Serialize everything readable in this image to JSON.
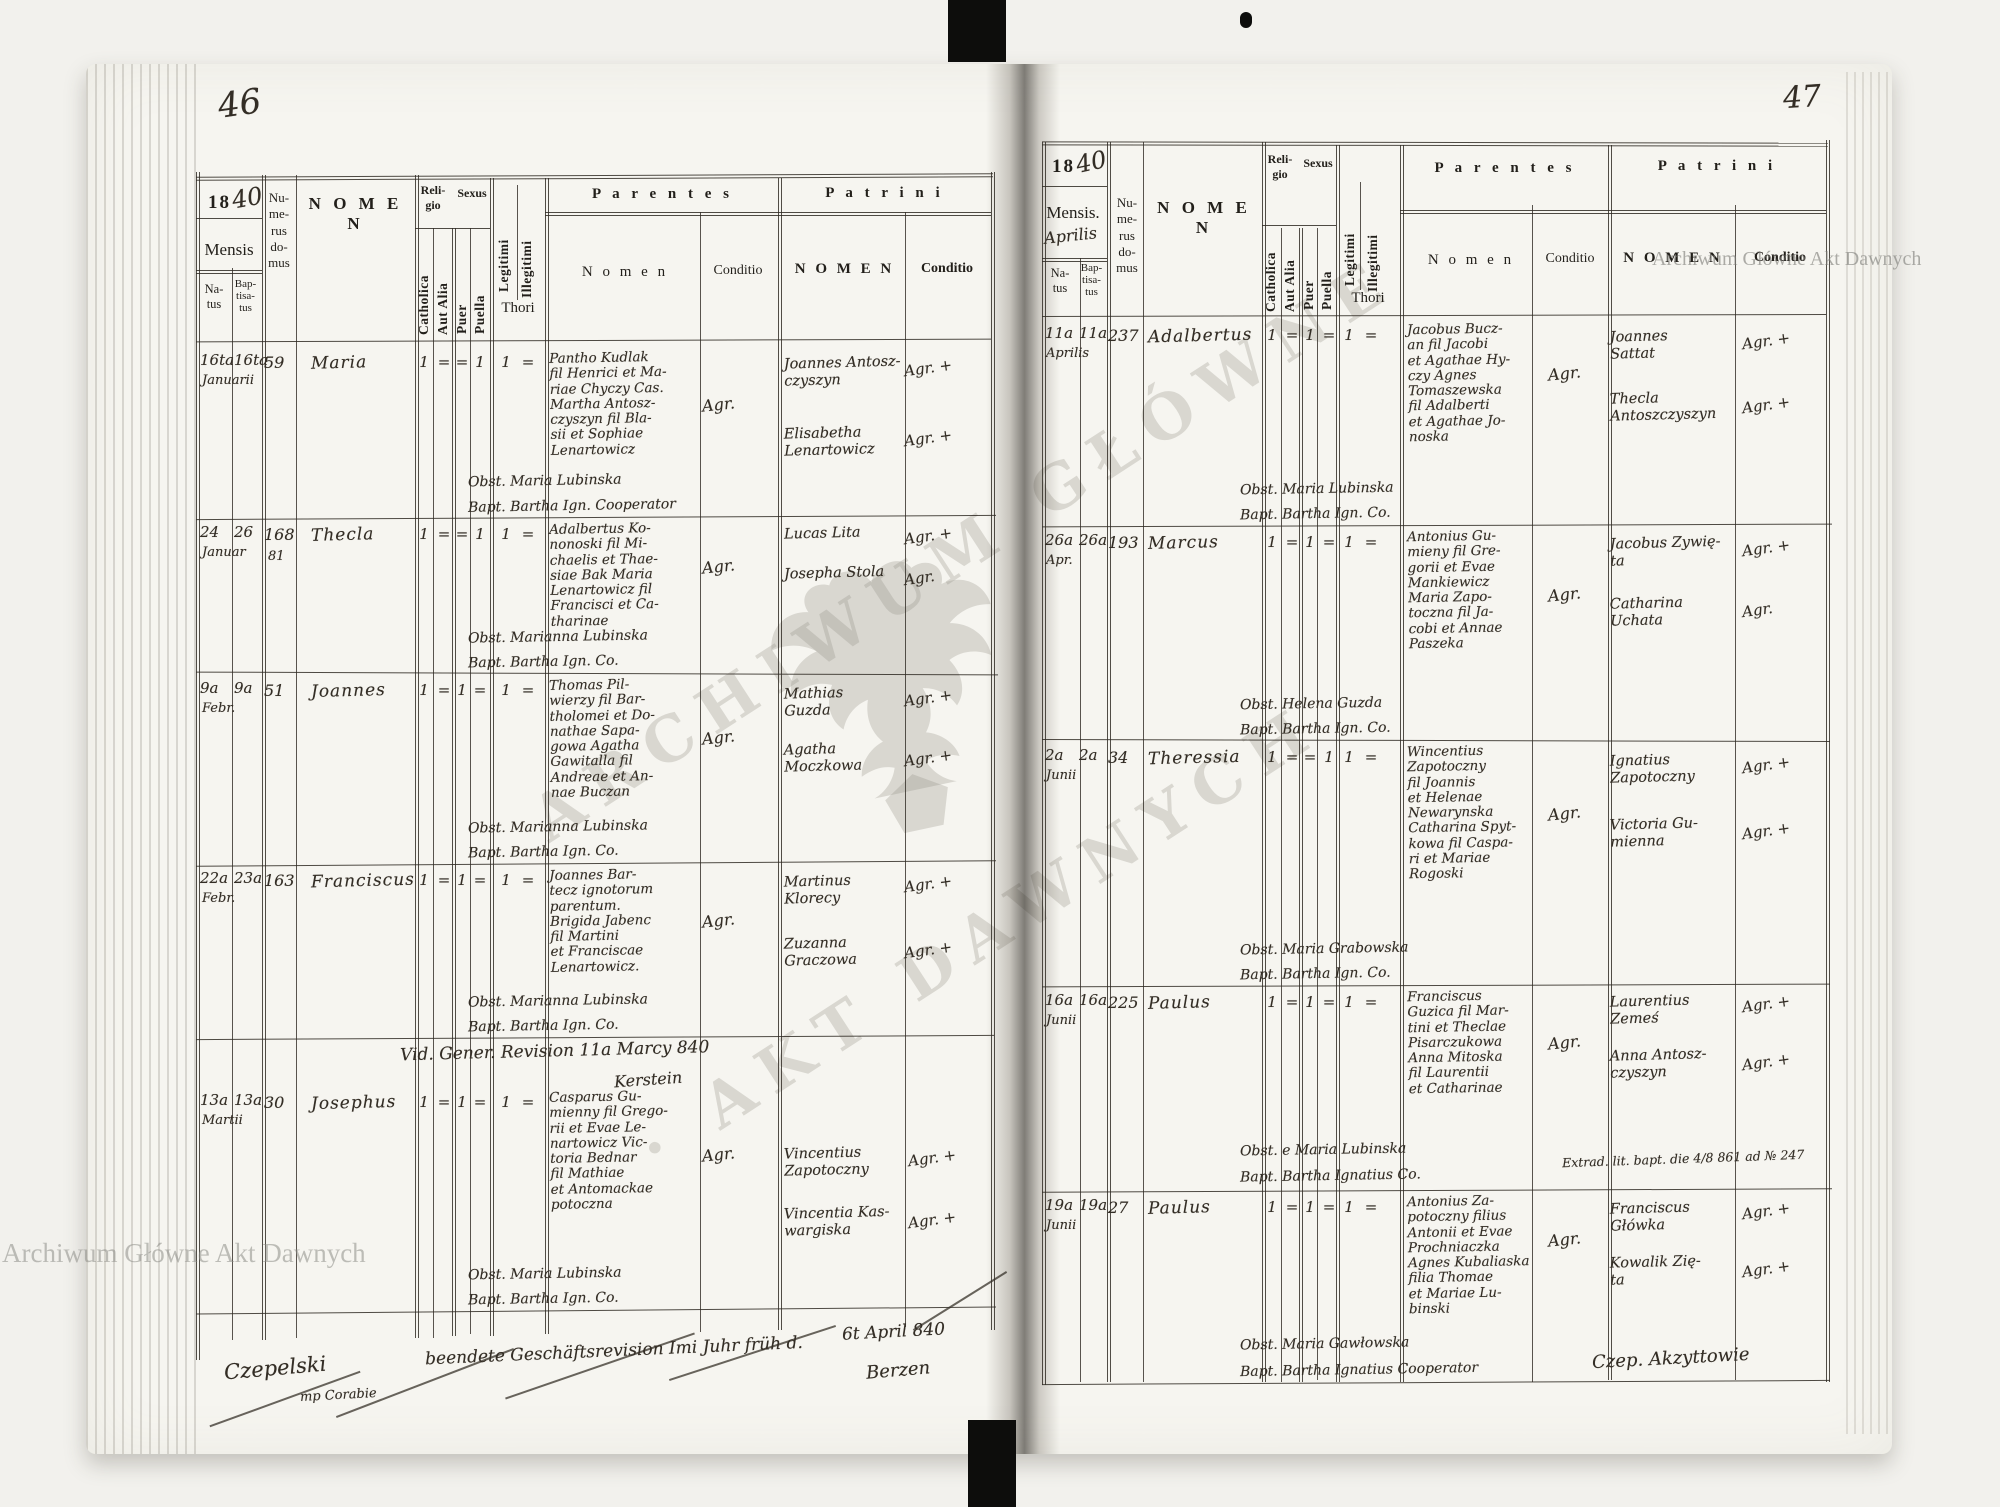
{
  "scan": {
    "page_left_number": "46",
    "page_right_number": "47",
    "watermark_top_right": "Archiwum Główne Akt Dawnych",
    "watermark_bottom_left": "Archiwum Główne Akt Dawnych",
    "watermark_center_line1": "ARCHIWUM GŁÓWNE",
    "watermark_center_line2": "· AKT DAWNYCH"
  },
  "labels": {
    "year_prefix": "18",
    "mensis": "Mensis",
    "mensis_dot": "Mensis.",
    "natus": "Na-\ntus",
    "baptisatus": "Bap-\ntisa-\ntus",
    "numerus": "Nu-\nme-\nrus\ndo-\nmus",
    "nomen_spaced": "N O M E N",
    "religio": "Reli-\ngio",
    "sexus": "Sexus",
    "catholica": "Catholica",
    "aut_alia": "Aut Alia",
    "puer": "Puer",
    "puella": "Puella",
    "legitimi": "Legitimi",
    "illegitimi": "Illegitimi",
    "thori": "Thori",
    "parentes": "P a r e n t e s",
    "patrini": "P a t r i n i",
    "parentes_nomen": "N o m e n",
    "conditio": "Conditio"
  },
  "left": {
    "year_hand": "40",
    "rows": [
      {
        "natus": "16ta",
        "bapt": "16ta",
        "month": "Januarii",
        "house": "59",
        "name": "Maria",
        "cath": "1",
        "alia": "=",
        "puer": "=",
        "puella": "1",
        "legit": "1",
        "illeg": "=",
        "parentes": "Pantho Kudlak\nfil Henrici et Ma-\nriae Chyczy Cas.\nMartha Antosz-\nczyszyn fil Bla-\nsii et Sophiae\nLenartowicz",
        "conditio": "Agr.",
        "obst": "Obst. Maria Lubinska",
        "baptizer": "Bapt. Bartha Ign. Cooperator",
        "patrini1": "Joannes Antosz-\nczyszyn",
        "cond1": "Agr. +",
        "patrini2": "Elisabetha\nLenartowicz",
        "cond2": "Agr. +"
      },
      {
        "natus": "24",
        "bapt": "26",
        "month": "Januar",
        "house": "168",
        "house2": "81",
        "name": "Thecla",
        "cath": "1",
        "alia": "=",
        "puer": "=",
        "puella": "1",
        "legit": "1",
        "illeg": "=",
        "parentes": "Adalbertus Ko-\nnonoski fil Mi-\nchaelis et Thae-\nsiae Bak Maria\nLenartowicz fil\nFrancisci et Ca-\ntharinae",
        "conditio": "Agr.",
        "obst": "Obst. Marianna Lubinska",
        "baptizer": "Bapt. Bartha Ign. Co.",
        "patrini1": "Lucas Lita",
        "cond1": "Agr. +",
        "patrini2": "Josepha Stola",
        "cond2": "Agr."
      },
      {
        "natus": "9a",
        "bapt": "9a",
        "month": "Febr.",
        "house": "51",
        "name": "Joannes",
        "cath": "1",
        "alia": "=",
        "puer": "1",
        "puella": "=",
        "legit": "1",
        "illeg": "=",
        "parentes": "Thomas Pil-\nwierzy fil Bar-\ntholomei et Do-\nnathae Sapa-\ngowa Agatha\nGawitalla fil\nAndreae et An-\nnae Buczan",
        "conditio": "Agr.",
        "obst": "Obst. Marianna Lubinska",
        "baptizer": "Bapt. Bartha Ign. Co.",
        "patrini1": "Mathias\nGuzda",
        "cond1": "Agr. +",
        "patrini2": "Agatha\nMoczkowa",
        "cond2": "Agr. +"
      },
      {
        "natus": "22a",
        "bapt": "23a",
        "month": "Febr.",
        "house": "163",
        "name": "Franciscus",
        "cath": "1",
        "alia": "=",
        "puer": "1",
        "puella": "=",
        "legit": "1",
        "illeg": "=",
        "parentes": "Joannes Bar-\ntecz ignotorum\nparentum.\nBrigida Jabenc\nfil Martini\net Franciscae\nLenartowicz.",
        "conditio": "Agr.",
        "obst": "Obst. Marianna Lubinska",
        "baptizer": "Bapt. Bartha Ign. Co.",
        "patrini1": "Martinus\nKlorecy",
        "cond1": "Agr. +",
        "patrini2": "Zuzanna\nGraczowa",
        "cond2": "Agr. +"
      },
      {
        "natus": "13a",
        "bapt": "13a",
        "month": "Martii",
        "house": "30",
        "name": "Josephus",
        "cath": "1",
        "alia": "=",
        "puer": "1",
        "puella": "=",
        "legit": "1",
        "illeg": "=",
        "parentes": "Casparus Gu-\nmienny fil Grego-\nrii et Evae Le-\nnartowicz Vic-\ntoria Bednar\nfil Mathiae\net Antomackae\npotoczna",
        "conditio": "Agr.",
        "obst": "Obst. Maria Lubinska",
        "baptizer": "Bapt. Bartha Ign. Co.",
        "patrini1": "Vincentius\nZapotoczny",
        "cond1": "Agr. +",
        "patrini2": "Vincentia Kas-\nwargiska",
        "cond2": "Agr. +"
      }
    ],
    "revision_note": "Vid. Gener. Revision 11a Marcy 840",
    "revision_sign": "Kerstein",
    "footer_line": "beendete Geschäftsrevision Imi Juhr früh d.",
    "footer_date": "6t April 840",
    "footer_place": "Berzen",
    "footer_sign": "Czepelski",
    "footer_sign_sub": "mp Corabie"
  },
  "right": {
    "year_hand": "40",
    "month_hand": "Aprilis",
    "rows": [
      {
        "natus": "11a",
        "bapt": "11a",
        "month": "Aprilis",
        "house": "237",
        "name": "Adalbertus",
        "cath": "1",
        "alia": "=",
        "puer": "1",
        "puella": "=",
        "legit": "1",
        "illeg": "=",
        "parentes": "Jacobus Bucz-\nan fil Jacobi\net Agathae Hy-\nczy Agnes\nTomaszewska\nfil Adalberti\net Agathae Jo-\nnoska",
        "conditio": "Agr.",
        "obst": "Obst. Maria Lubinska",
        "baptizer": "Bapt. Bartha Ign. Co.",
        "patrini1": "Joannes\nSattat",
        "cond1": "Agr. +",
        "patrini2": "Thecla\nAntoszczyszyn",
        "cond2": "Agr. +"
      },
      {
        "natus": "26a",
        "bapt": "26a",
        "month": "Apr.",
        "house": "193",
        "name": "Marcus",
        "cath": "1",
        "alia": "=",
        "puer": "1",
        "puella": "=",
        "legit": "1",
        "illeg": "=",
        "parentes": "Antonius Gu-\nmieny fil Gre-\ngorii et Evae\nMankiewicz\nMaria Zapo-\ntoczna fil Ja-\ncobi et Annae\nPaszeka",
        "conditio": "Agr.",
        "obst": "Obst. Helena Guzda",
        "baptizer": "Bapt. Bartha Ign. Co.",
        "patrini1": "Jacobus Zywię-\nta",
        "cond1": "Agr. +",
        "patrini2": "Catharina\nUchata",
        "cond2": "Agr."
      },
      {
        "natus": "2a",
        "bapt": "2a",
        "month": "Junii",
        "house": "34",
        "name": "Theressia",
        "cath": "1",
        "alia": "=",
        "puer": "=",
        "puella": "1",
        "legit": "1",
        "illeg": "=",
        "parentes": "Wincentius\nZapotoczny\nfil Joannis\net Helenae\nNewarynska\nCatharina Spyt-\nkowa fil Caspa-\nri et Mariae\nRogoski",
        "conditio": "Agr.",
        "obst": "Obst. Maria Grabowska",
        "baptizer": "Bapt. Bartha Ign. Co.",
        "patrini1": "Ignatius\nZapotoczny",
        "cond1": "Agr. +",
        "patrini2": "Victoria Gu-\nmienna",
        "cond2": "Agr. +"
      },
      {
        "natus": "16a",
        "bapt": "16a",
        "month": "Junii",
        "house": "225",
        "name": "Paulus",
        "cath": "1",
        "alia": "=",
        "puer": "1",
        "puella": "=",
        "legit": "1",
        "illeg": "=",
        "parentes": "Franciscus\nGuzica fil Mar-\ntini et Theclae\nPisarczukowa\nAnna Mitoska\nfil Laurentii\net Catharinae",
        "conditio": "Agr.",
        "obst": "Obst. e Maria Lubinska",
        "baptizer": "Bapt. Bartha Ignatius Co.",
        "patrini1": "Laurentius\nZemeś",
        "cond1": "Agr. +",
        "patrini2": "Anna Antosz-\nczyszyn",
        "cond2": "Agr. +"
      },
      {
        "natus": "19a",
        "bapt": "19a",
        "month": "Junii",
        "house": "27",
        "name": "Paulus",
        "cath": "1",
        "alia": "=",
        "puer": "1",
        "puella": "=",
        "legit": "1",
        "illeg": "=",
        "parentes": "Antonius Za-\npotoczny filius\nAntonii et Evae\nProchniaczka\nAgnes Kubaliaska\nfilia Thomae\net Mariae Lu-\nbinski",
        "conditio": "Agr.",
        "obst": "Obst. Maria Gawłowska",
        "baptizer": "Bapt. Bartha Ignatius Cooperator",
        "patrini1": "Franciscus\nGłówka",
        "cond1": "Agr. +",
        "patrini2": "Kowalik Zię-\nta",
        "cond2": "Agr. +"
      }
    ],
    "extrad_note": "Extrad. lit. bapt. die 4/8 861 ad № 247",
    "footer_sign": "Czep. Akzyttowie"
  }
}
